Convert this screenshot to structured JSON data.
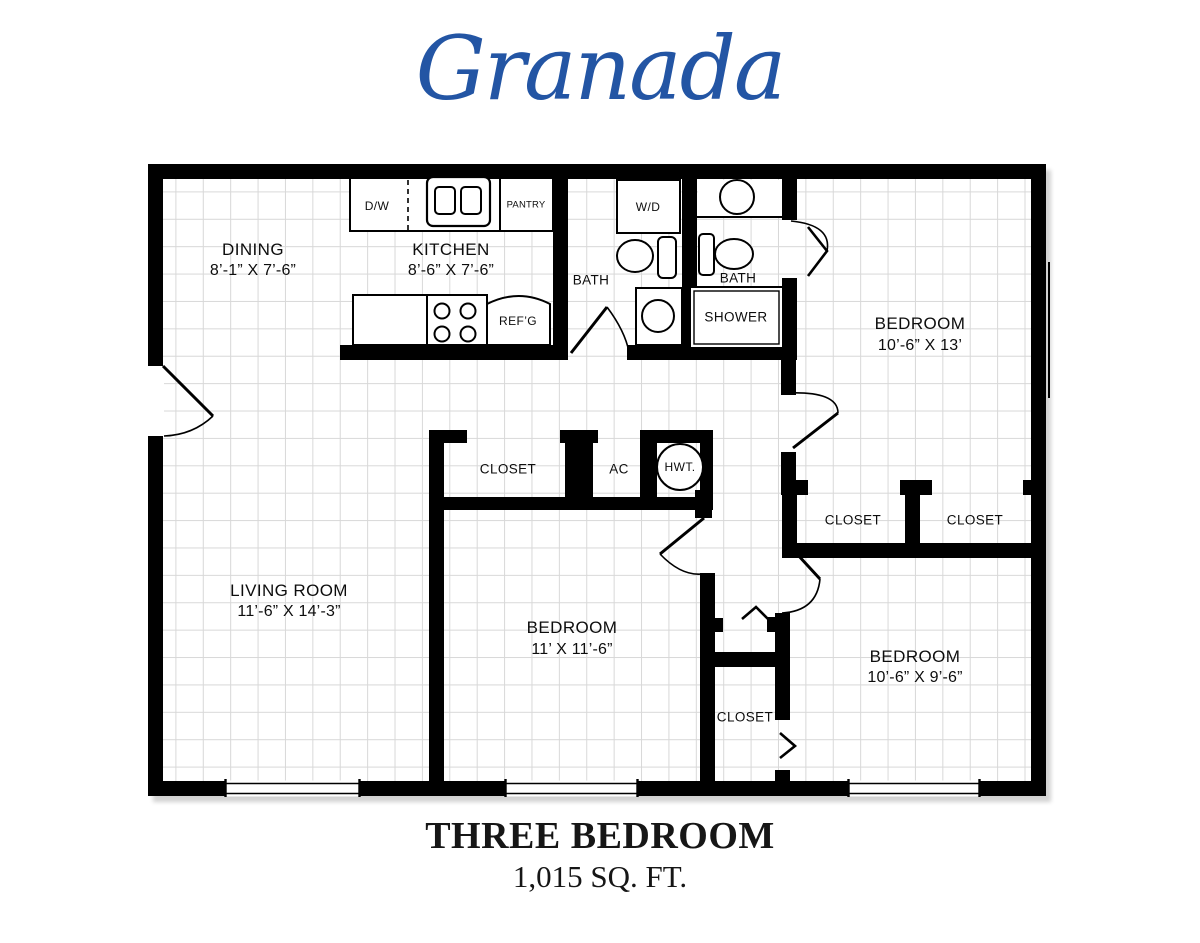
{
  "title": "Granada",
  "colors": {
    "title_blue": "#2355a4",
    "wall": "#000000",
    "grid": "#d8d8d8"
  },
  "plan": {
    "rooms": {
      "dining": {
        "name": "DINING",
        "dims": "8’-1” X 7’-6”"
      },
      "kitchen": {
        "name": "KITCHEN",
        "dims": "8’-6” X 7’-6”"
      },
      "bath1": {
        "name": "BATH"
      },
      "bath2": {
        "name": "BATH"
      },
      "bedroom1": {
        "name": "BEDROOM",
        "dims": "10’-6” X 13’"
      },
      "living": {
        "name": "LIVING ROOM",
        "dims": "11’-6” X 14’-3”"
      },
      "bedroom2": {
        "name": "BEDROOM",
        "dims": "11’ X 11’-6”"
      },
      "bedroom3": {
        "name": "BEDROOM",
        "dims": "10’-6” X 9’-6”"
      },
      "hall_closet": {
        "name": "CLOSET"
      },
      "ac_closet": {
        "name": "AC"
      },
      "closet_right1": {
        "name": "CLOSET"
      },
      "closet_right2": {
        "name": "CLOSET"
      },
      "closet_bottom": {
        "name": "CLOSET"
      }
    },
    "fixtures": {
      "dishwasher": "D/W",
      "pantry": "PANTRY",
      "washer_dryer": "W/D",
      "refrigerator": "REF’G",
      "shower": "SHOWER",
      "water_heater": "HWT."
    }
  },
  "footer": {
    "plan_type": "THREE BEDROOM",
    "area": "1,015 SQ. FT."
  }
}
